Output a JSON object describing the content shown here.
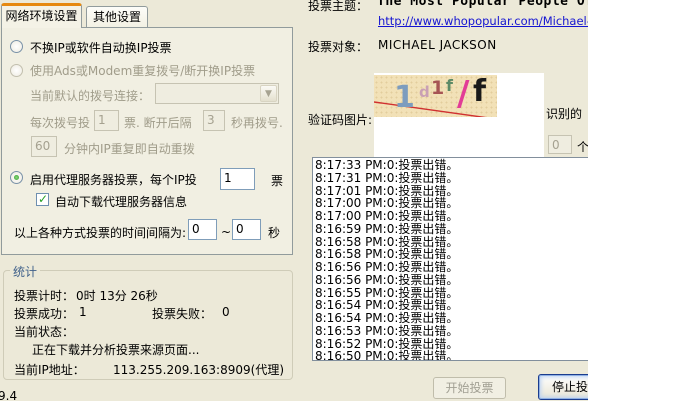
{
  "tabs": {
    "active": "网络环境设置",
    "other": "其他设置"
  },
  "network_panel": {
    "radio_no_change_ip": "不换IP或软件自动换IP投票",
    "radio_adsl": "使用Ads或Modem重复拨号/断开换IP投票",
    "dial_connection_label": "当前默认的拨号连接：",
    "dial_votes_prefix": "每次拨号投",
    "dial_votes_value": "1",
    "dial_votes_mid": "票. 断开后隔",
    "dial_wait_value": "3",
    "dial_votes_suffix": "秒再拨号.",
    "redial_minutes_value": "60",
    "redial_suffix": "分钟内IP重复即自动重拨",
    "radio_proxy_prefix": "启用代理服务器投票，每个IP投",
    "proxy_votes_value": "1",
    "proxy_votes_suffix": "票",
    "checkbox_auto_download": "自动下载代理服务器信息",
    "interval_prefix": "以上各种方式投票的时间间隔为:",
    "interval_min": "0",
    "interval_tilde": "~",
    "interval_max": "0",
    "interval_suffix": "秒"
  },
  "stats": {
    "title": "统计",
    "timer_label": "投票计时：",
    "timer_value": "0时 13分 26秒",
    "success_label": "投票成功：",
    "success_value": "1",
    "fail_label": "投票失败：",
    "fail_value": "0",
    "status_label": "当前状态：",
    "status_value": "正在下载并分析投票来源页面...",
    "ip_label": "当前IP地址：",
    "ip_value": "113.255.209.163:8909(代理)"
  },
  "vote_info": {
    "topic_label": "投票主题：",
    "topic_value": "The Most Popular People Of",
    "topic_url": "http://www.whopopular.com/Michael-Jacks",
    "target_label": "投票对象：",
    "target_value": "MICHAEL JACKSON",
    "captcha_label": "验证码图片:",
    "captcha_text": "1d1f/f",
    "captcha_chars": [
      {
        "ch": "1",
        "left": 20,
        "top": 8,
        "size": 30,
        "color": "#7C9CBE"
      },
      {
        "ch": "d",
        "left": 45,
        "top": 10,
        "size": 15,
        "color": "#C9A0B4"
      },
      {
        "ch": "1",
        "left": 57,
        "top": 4,
        "size": 19,
        "color": "#A65454"
      },
      {
        "ch": "f",
        "left": 72,
        "top": 3,
        "size": 16,
        "color": "#5C8A66"
      },
      {
        "ch": "/",
        "left": 83,
        "top": 2,
        "size": 34,
        "color": "#E23C96"
      },
      {
        "ch": "f",
        "left": 99,
        "top": 2,
        "size": 30,
        "color": "#1A1A1A"
      }
    ],
    "recognized_label": "识别的",
    "recognized_count": "0",
    "recognized_unit": "个"
  },
  "log": {
    "entries": [
      "8:17:33 PM:0:投票出错。",
      "8:17:31 PM:0:投票出错。",
      "8:17:01 PM:0:投票出错。",
      "8:17:00 PM:0:投票出错。",
      "8:17:00 PM:0:投票出错。",
      "8:16:59 PM:0:投票出错。",
      "8:16:58 PM:0:投票出错。",
      "8:16:58 PM:0:投票出错。",
      "8:16:56 PM:0:投票出错。",
      "8:16:56 PM:0:投票出错。",
      "8:16:55 PM:0:投票出错。",
      "8:16:54 PM:0:投票出错。",
      "8:16:54 PM:0:投票出错。",
      "8:16:53 PM:0:投票出错。",
      "8:16:52 PM:0:投票出错。",
      "8:16:50 PM:0:投票出错。"
    ]
  },
  "buttons": {
    "start": "开始投票",
    "stop": "停止投票"
  },
  "statusbar": {
    "fragment": "9.4"
  },
  "colors": {
    "dialog_bg": "#ECE9D8",
    "tab_accent_orange": "#E68910",
    "link_blue": "#1414D2",
    "groupbox_label_blue": "#40618A",
    "captcha_bg": "#F2E1B7",
    "captcha_strike_red": "#D03030",
    "selected_green": "#2E9E2B"
  }
}
